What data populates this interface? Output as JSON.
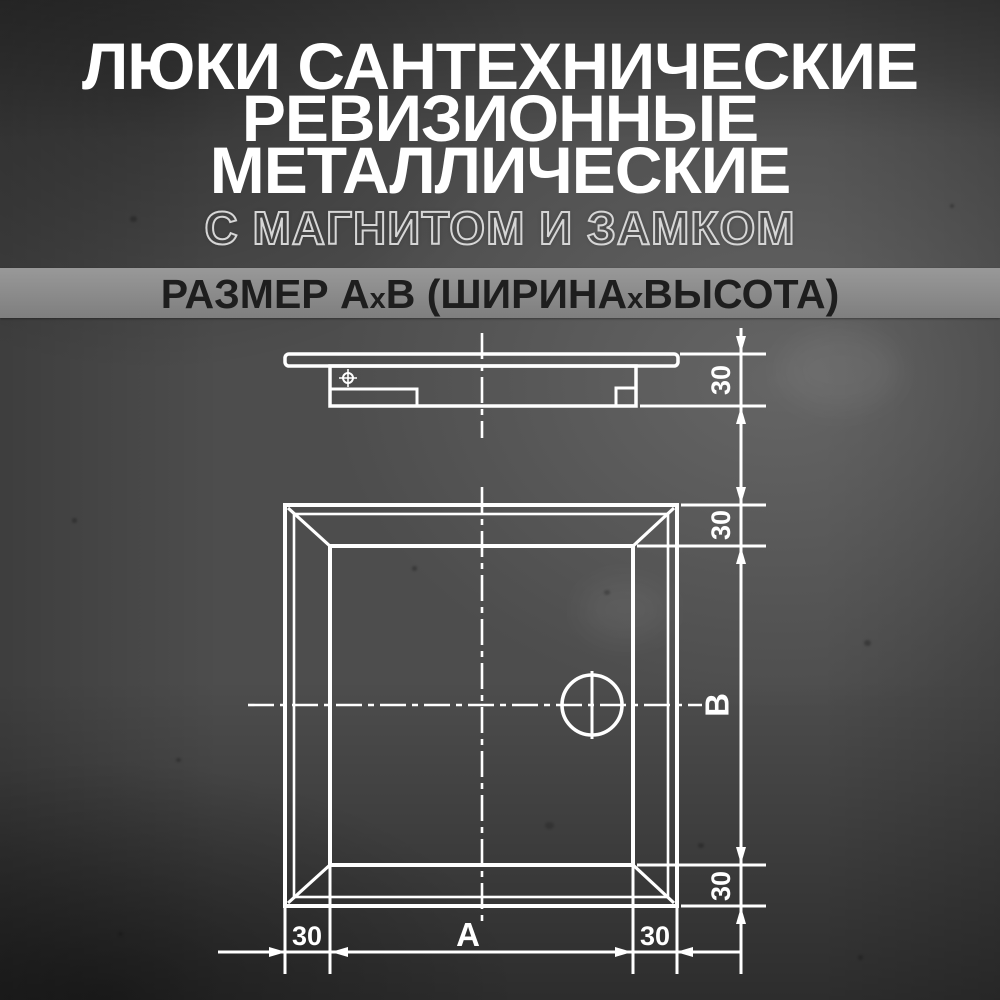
{
  "header": {
    "title_lines": [
      "ЛЮКИ САНТЕХНИЧЕСКИЕ",
      "РЕВИЗИОННЫЕ",
      "МЕТАЛЛИЧЕСКИЕ"
    ],
    "subtitle": "С МАГНИТОМ И ЗАМКОМ",
    "size_banner": {
      "full_text": "РАЗМЕР АхВ (ШИРИНАхВЫСОТА)",
      "segments": {
        "part1": "РАЗМЕР А",
        "sep1": "х",
        "part2": "В (ШИРИНА",
        "sep2": "х",
        "part3": "ВЫСОТА)"
      }
    }
  },
  "drawing": {
    "side_view": {
      "depth_label": "30"
    },
    "front_view": {
      "top_frame_label": "30",
      "height_label": "В",
      "bottom_frame_label": "30",
      "left_frame_label": "30",
      "width_label": "А",
      "right_frame_label": "30"
    }
  },
  "colors": {
    "background_mid": "#4d4d4d",
    "background_light": "#5c5c5c",
    "background_dark": "#262626",
    "drawing_line": "#ffffff",
    "banner_bg": "#8d8d8d",
    "banner_text": "#1e1e1e",
    "title_text": "#ffffff",
    "subtitle_stroke": "#d6d6d6"
  }
}
